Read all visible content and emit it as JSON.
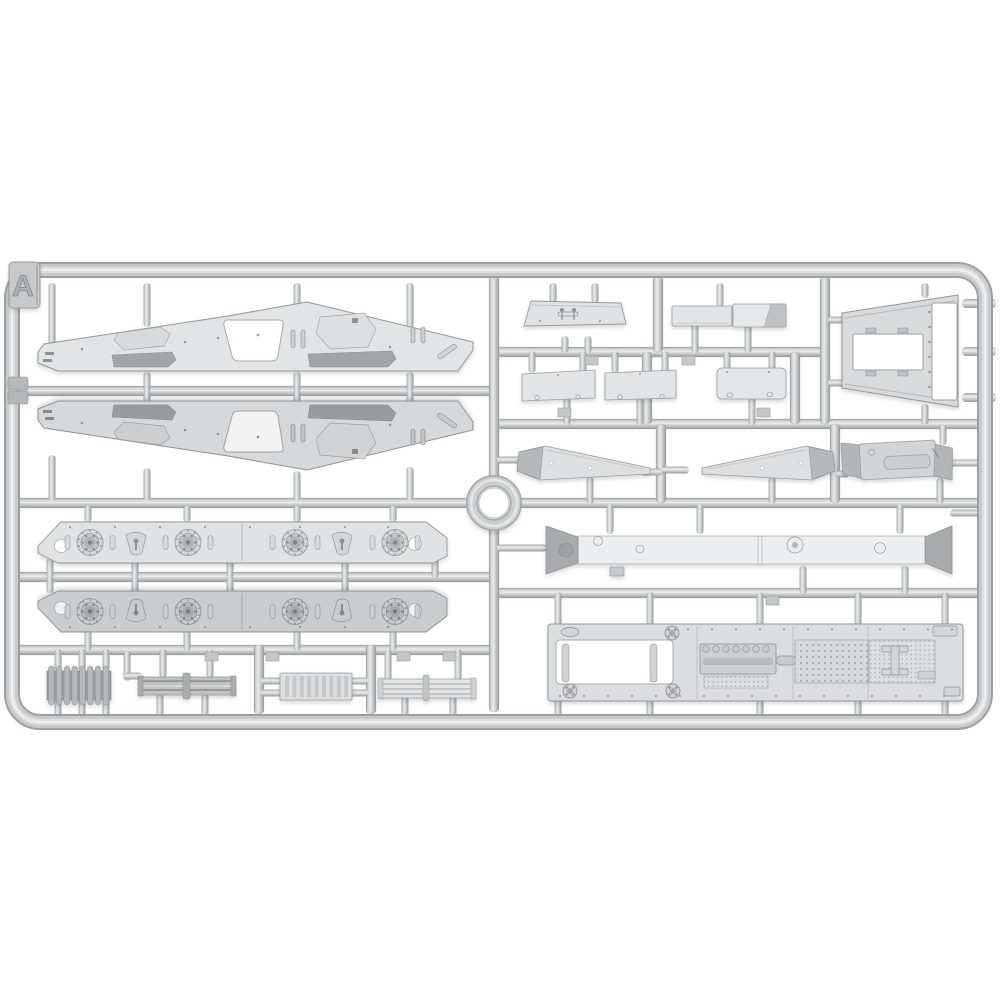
{
  "sprue": {
    "label": "A",
    "parts": [
      "fender-upper",
      "fender-lower",
      "hull-side-upper",
      "hull-side-lower",
      "radiator-grille-dark",
      "slat-assembly-dark",
      "radiator-grille-light",
      "slat-assembly-light",
      "glacis-panel",
      "flat-panel-a",
      "flat-panel-b",
      "radiator-frame",
      "small-hatch-panel-1",
      "small-hatch-panel-2",
      "small-hatch-panel-3",
      "mudguard-blade-left",
      "mudguard-blade-right",
      "muffler-box",
      "hull-roof-beam",
      "hull-floor-plate"
    ]
  },
  "colors": {
    "background": "#ffffff",
    "plastic_light": "#e3e5e7",
    "plastic_mid": "#d2d4d6",
    "plastic_dark": "#a9abad",
    "runner_light": "#e9ebec",
    "runner_dark": "#97999b",
    "outline": "#94969a",
    "shadow": "rgba(0,0,0,0.16)"
  }
}
